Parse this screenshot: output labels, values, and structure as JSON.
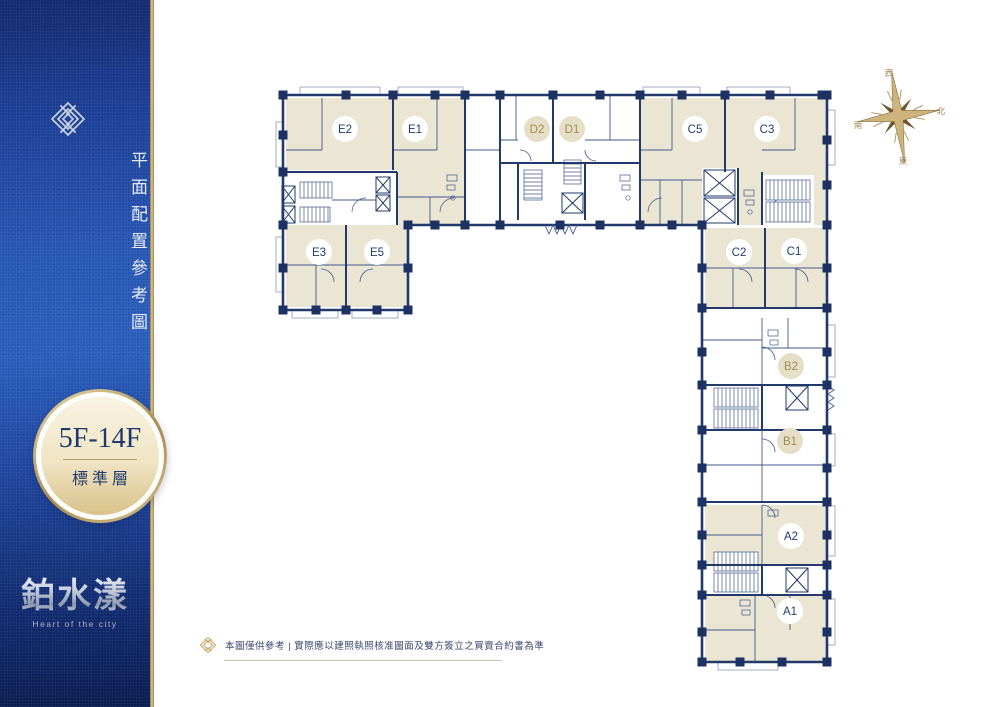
{
  "sidebar": {
    "vertical_title": "平面配置參考圖",
    "badge": {
      "floors": "5F-14F",
      "label": "標準層"
    },
    "logo_text": "鉑水漾",
    "logo_subtitle": "Heart of the city"
  },
  "floorplan": {
    "compass": {
      "top": "西",
      "right": "北",
      "left": "南",
      "bottom": "東"
    },
    "units": [
      {
        "label": "E2",
        "x": 345,
        "y": 129,
        "style": "light"
      },
      {
        "label": "E1",
        "x": 415,
        "y": 129,
        "style": "light"
      },
      {
        "label": "D2",
        "x": 537,
        "y": 129,
        "style": "beige"
      },
      {
        "label": "D1",
        "x": 572,
        "y": 129,
        "style": "beige"
      },
      {
        "label": "C5",
        "x": 695,
        "y": 129,
        "style": "light"
      },
      {
        "label": "C3",
        "x": 767,
        "y": 129,
        "style": "light"
      },
      {
        "label": "E3",
        "x": 319,
        "y": 252,
        "style": "light"
      },
      {
        "label": "E5",
        "x": 377,
        "y": 252,
        "style": "light"
      },
      {
        "label": "C2",
        "x": 739,
        "y": 252,
        "style": "light"
      },
      {
        "label": "C1",
        "x": 794,
        "y": 251,
        "style": "light"
      },
      {
        "label": "B2",
        "x": 791,
        "y": 366,
        "style": "beige"
      },
      {
        "label": "B1",
        "x": 790,
        "y": 441,
        "style": "beige"
      },
      {
        "label": "A2",
        "x": 791,
        "y": 536,
        "style": "light"
      },
      {
        "label": "A1",
        "x": 790,
        "y": 611,
        "style": "light"
      }
    ]
  },
  "disclaimer": {
    "icon": "knot-icon",
    "text": "本圖僅供參考 | 實際應以建照執照核准圖面及雙方簽立之買賣合約書為準"
  },
  "colors": {
    "wall_navy": "#22396b",
    "unit_beige": "#ebe5d4",
    "badge_gold": "#b49a63",
    "sidebar_blue": "#2a5ebd",
    "label_gold": "#a4894f",
    "label_navy": "#223c6e"
  }
}
